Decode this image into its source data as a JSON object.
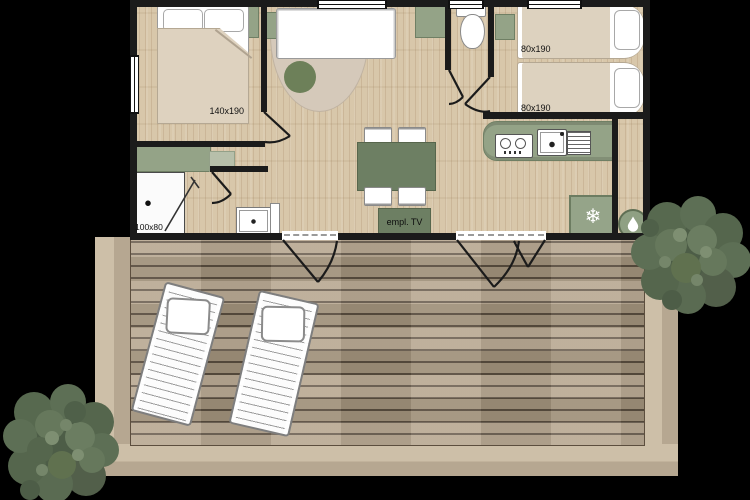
{
  "floor_plan": {
    "furniture_labels": {
      "double_bed": "140x190",
      "single_bed_top": "80x190",
      "single_bed_bottom": "80x190",
      "shower": "100x80",
      "tv_unit": "empl. TV"
    },
    "icons": {
      "fridge": "snowflake-icon",
      "fridge_glyph": "❄",
      "water_heater": "water-drop-icon"
    },
    "colors": {
      "background": "#000000",
      "walls": "#1b1b1b",
      "interior_floor": "#d8c7aa",
      "deck_wood": "#b2a189",
      "furniture_green": "#94a387",
      "accent_green_dark": "#6d7f63",
      "linen_beige": "#ddd2bf",
      "rug_beige": "#d5c9ba",
      "tree_green": "#5d6f55",
      "white": "#ffffff"
    }
  }
}
